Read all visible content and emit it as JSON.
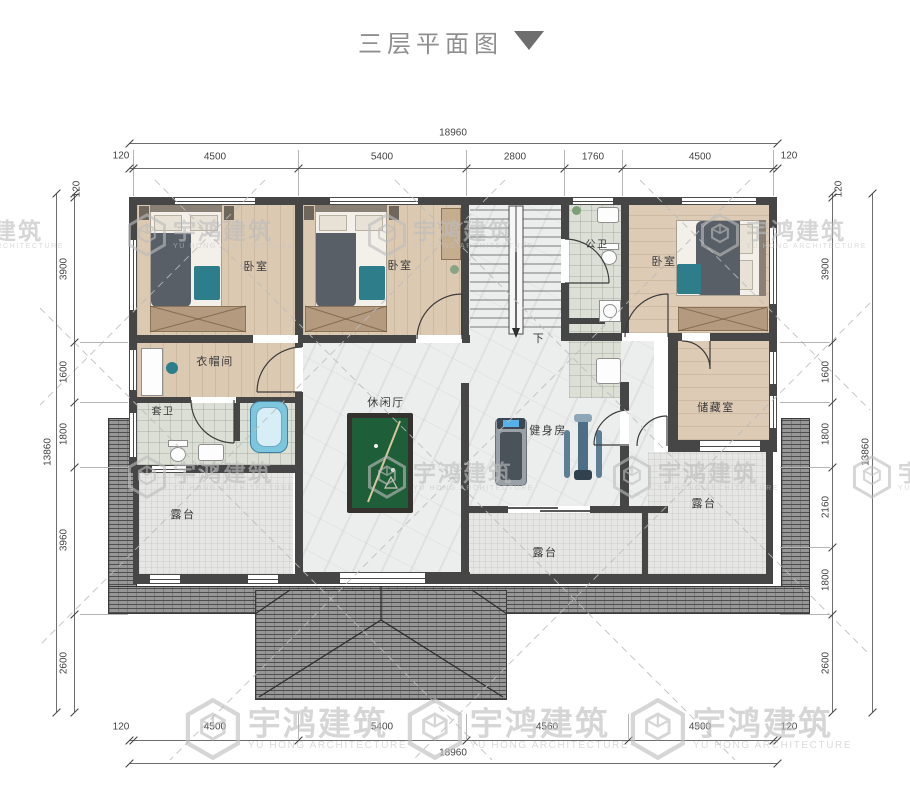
{
  "title": {
    "text": "三层平面图"
  },
  "watermark": {
    "cn": "宇鸿建筑",
    "en": "YU HONG ARCHITECTURE"
  },
  "rooms": {
    "bedroom_left": "卧室",
    "bedroom_mid": "卧室",
    "bedroom_right": "卧室",
    "public_bath": "公卫",
    "cloakroom": "衣帽间",
    "suite_bath": "套卫",
    "leisure_hall": "休闲厅",
    "gym": "健身房",
    "storage": "储藏室",
    "terrace_left": "露台",
    "terrace_mid": "露台",
    "terrace_right": "露台",
    "stair_down": "下"
  },
  "dims": {
    "top": {
      "total": "18960",
      "segs": [
        "120",
        "4500",
        "5400",
        "2800",
        "1760",
        "4500",
        "120"
      ]
    },
    "bottom": {
      "total": "18960",
      "segs": [
        "120",
        "4500",
        "5400",
        "4560",
        "4500",
        "120"
      ]
    },
    "left": {
      "total": "13860",
      "segs": [
        "120",
        "3900",
        "1600",
        "1800",
        "3960",
        "2600"
      ]
    },
    "right": {
      "total": "13860",
      "segs": [
        "120",
        "3900",
        "1600",
        "1800",
        "2160",
        "1800",
        "2600"
      ]
    }
  },
  "colors": {
    "wall": "#464646",
    "wood": "#dcc9b2",
    "marble": "#eceded",
    "tile": "#dbdfd5",
    "terrace": "#e6e6e4",
    "roof": "#979797",
    "pool_green": "#1e5e39",
    "accent_teal": "#2e7d8a",
    "watermark": "#bdbdbd",
    "dim_text": "#444444"
  }
}
